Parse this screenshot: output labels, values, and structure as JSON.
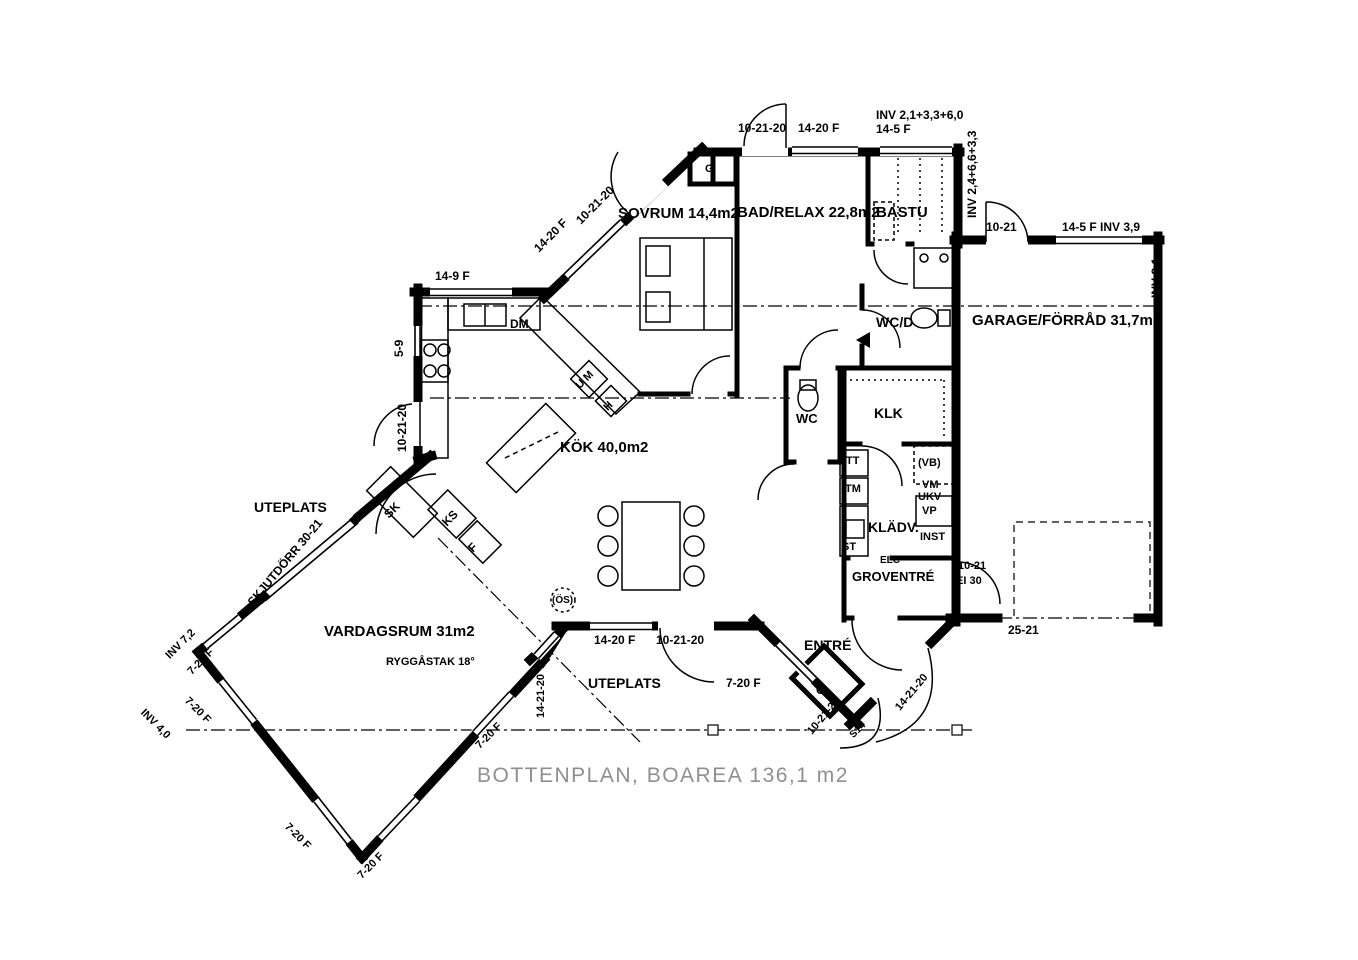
{
  "title": "BOTTENPLAN, BOAREA 136,1 m2",
  "rooms": {
    "sovrum": "SOVRUM 14,4m2",
    "bad_relax": "BAD/RELAX 22,8m2",
    "bastu": "BASTU",
    "wc_d": "WC/D",
    "garage": "GARAGE/FÖRRÅD 31,7m2",
    "kok": "KÖK 40,0m2",
    "wc": "WC",
    "klk": "KLK",
    "kladv": "KLÄDV.",
    "groventre": "GROVENTRÉ",
    "entre": "ENTRÉ",
    "uteplats_left": "UTEPLATS",
    "uteplats_bottom": "UTEPLATS",
    "vardagsrum": "VARDAGSRUM 31m2",
    "ryggastak": "RYGGÅSTAK 18°"
  },
  "fixtures": {
    "g_sovrum": "G",
    "g_entre": "G",
    "dm": "DM",
    "um": "U M",
    "h": "H",
    "sk": "SK",
    "ks": "KS",
    "f": "F",
    "tt": "TT",
    "tm": "TM",
    "st": "ST",
    "vb": "(VB)",
    "vm": "VM",
    "ukv": "UKV",
    "vp": "VP",
    "inst": "INST",
    "elc": "ELC",
    "os": "(ÖS)"
  },
  "dims": {
    "top_door": "10-21-20",
    "top_window": "14-20 F",
    "inv_top": "INV 2,1+3,3+6,0",
    "top_window2": "14-5 F",
    "inv_right": "INV 2,4+6,6+3,3",
    "garage_door": "10-21",
    "garage_window": "14-5 F INV 3,9",
    "inv_garage": "INV 8,1",
    "diag_window_nw": "14-20 F",
    "diag_door_nw": "10-21-20",
    "kitchen_window": "14-9 F",
    "kitchen_small": "5-9",
    "kitchen_door": "10-21-20",
    "skjutdorr": "SKJUTDÖRR 30-21",
    "inv_72": "INV 7,2",
    "w_nw1": "7-20 F",
    "inv_40": "INV 4,0",
    "w_sw1": "7-20 F",
    "w_sw2": "7-20 F",
    "w_se1": "7-20 F",
    "w_se2": "7-20 F",
    "w_vert": "14-21-20",
    "uteplats_window": "14-20 F",
    "uteplats_door": "10-21-20",
    "entre_window": "7-20 F",
    "entre_door1": "10-21-20",
    "entre_door2": "14-21-20",
    "s14": "S14",
    "groventre_door": "10-21",
    "ei30": "EI 30",
    "garage_opening": "25-21"
  }
}
